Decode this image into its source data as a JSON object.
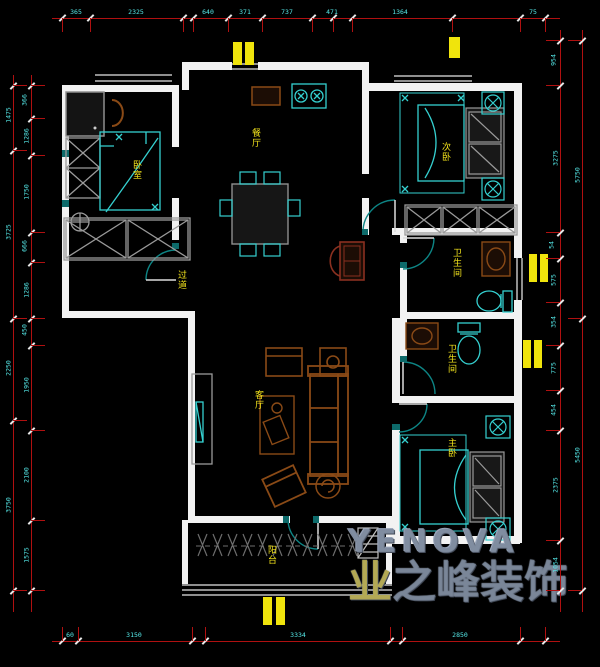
{
  "canvas": {
    "w": 600,
    "h": 667,
    "bg": "#000000"
  },
  "colors": {
    "wall": "#f2f2f2",
    "dim_line": "#b01010",
    "dim_text": "#55e8e8",
    "room_label": "#f5e51c",
    "furniture_cyan": "#35d0d0",
    "furniture_brown": "#8a4a16",
    "door_arc": "#0d8585",
    "radiator": "#f0e40c",
    "watermark": "#7c8798"
  },
  "rooms": [
    {
      "id": "bedroom-left",
      "label": "卧室",
      "x": 131,
      "y": 160
    },
    {
      "id": "dining",
      "label": "餐厅",
      "x": 250,
      "y": 128
    },
    {
      "id": "bedroom-top-right",
      "label": "次卧",
      "x": 440,
      "y": 142
    },
    {
      "id": "bathroom-1",
      "label": "卫生间",
      "x": 451,
      "y": 248
    },
    {
      "id": "bathroom-2",
      "label": "卫生间",
      "x": 446,
      "y": 344
    },
    {
      "id": "hallway",
      "label": "过道",
      "x": 176,
      "y": 270
    },
    {
      "id": "living",
      "label": "客厅",
      "x": 253,
      "y": 390
    },
    {
      "id": "bedroom-bottom-right",
      "label": "主卧",
      "x": 446,
      "y": 438
    },
    {
      "id": "balcony",
      "label": "阳台",
      "x": 266,
      "y": 545
    }
  ],
  "radiators": [
    {
      "x": 233,
      "y": 42,
      "w": 9,
      "h": 23
    },
    {
      "x": 245,
      "y": 42,
      "w": 9,
      "h": 23
    },
    {
      "x": 449,
      "y": 37,
      "w": 11,
      "h": 21
    },
    {
      "x": 529,
      "y": 254,
      "w": 8,
      "h": 28
    },
    {
      "x": 540,
      "y": 254,
      "w": 8,
      "h": 28
    },
    {
      "x": 523,
      "y": 340,
      "w": 8,
      "h": 28
    },
    {
      "x": 534,
      "y": 340,
      "w": 8,
      "h": 28
    },
    {
      "x": 263,
      "y": 597,
      "w": 9,
      "h": 28
    },
    {
      "x": 276,
      "y": 597,
      "w": 9,
      "h": 28
    }
  ],
  "dimensions": {
    "horizontal": [
      {
        "id": "top",
        "y": 18,
        "x1": 52,
        "x2": 560,
        "ticks": [
          62,
          90,
          183,
          193,
          228,
          262,
          312,
          333,
          352,
          452,
          520,
          545
        ],
        "labels": [
          {
            "x": 76,
            "t": "365"
          },
          {
            "x": 136,
            "t": "2325"
          },
          {
            "x": 208,
            "t": "640"
          },
          {
            "x": 245,
            "t": "371"
          },
          {
            "x": 287,
            "t": "737"
          },
          {
            "x": 332,
            "t": "471"
          },
          {
            "x": 400,
            "t": "1364"
          },
          {
            "x": 533,
            "t": "75"
          }
        ]
      },
      {
        "id": "bottom",
        "y": 641,
        "x1": 52,
        "x2": 560,
        "ticks": [
          62,
          78,
          192,
          205,
          390,
          402,
          520,
          545
        ],
        "labels": [
          {
            "x": 70,
            "t": "60"
          },
          {
            "x": 134,
            "t": "3150"
          },
          {
            "x": 298,
            "t": "3334"
          },
          {
            "x": 460,
            "t": "2850"
          }
        ]
      }
    ],
    "vertical": [
      {
        "id": "left-outer",
        "x": 13,
        "y1": 75,
        "y2": 612,
        "ticks": [
          85,
          150,
          318,
          420,
          590
        ],
        "labels": [
          {
            "y": 115,
            "t": "1475"
          },
          {
            "y": 232,
            "t": "3725"
          },
          {
            "y": 368,
            "t": "2250"
          },
          {
            "y": 505,
            "t": "3750"
          }
        ]
      },
      {
        "id": "left-inner",
        "x": 31,
        "y1": 75,
        "y2": 612,
        "ticks": [
          85,
          118,
          155,
          232,
          262,
          318,
          345,
          430,
          520,
          590
        ],
        "labels": [
          {
            "y": 100,
            "t": "366"
          },
          {
            "y": 136,
            "t": "1286"
          },
          {
            "y": 192,
            "t": "1750"
          },
          {
            "y": 246,
            "t": "666"
          },
          {
            "y": 290,
            "t": "1286"
          },
          {
            "y": 330,
            "t": "450"
          },
          {
            "y": 385,
            "t": "1950"
          },
          {
            "y": 475,
            "t": "2100"
          },
          {
            "y": 555,
            "t": "1575"
          }
        ]
      },
      {
        "id": "right-inner",
        "x": 560,
        "y1": 30,
        "y2": 612,
        "ticks": [
          40,
          85,
          232,
          258,
          302,
          345,
          390,
          430,
          540,
          590
        ],
        "labels": [
          {
            "y": 60,
            "t": "954"
          },
          {
            "y": 158,
            "t": "3275"
          },
          {
            "y": 245,
            "t": "54"
          },
          {
            "y": 280,
            "t": "575"
          },
          {
            "y": 322,
            "t": "354"
          },
          {
            "y": 368,
            "t": "775"
          },
          {
            "y": 410,
            "t": "454"
          },
          {
            "y": 485,
            "t": "2375"
          },
          {
            "y": 565,
            "t": "1054"
          }
        ]
      },
      {
        "id": "right-outer",
        "x": 582,
        "y1": 30,
        "y2": 612,
        "ticks": [
          40,
          318,
          590
        ],
        "labels": [
          {
            "y": 175,
            "t": "5750"
          },
          {
            "y": 455,
            "t": "5450"
          }
        ]
      }
    ]
  },
  "watermark": {
    "brand": "YENOVA",
    "company_first": "业",
    "company_rest": "之峰装饰"
  }
}
